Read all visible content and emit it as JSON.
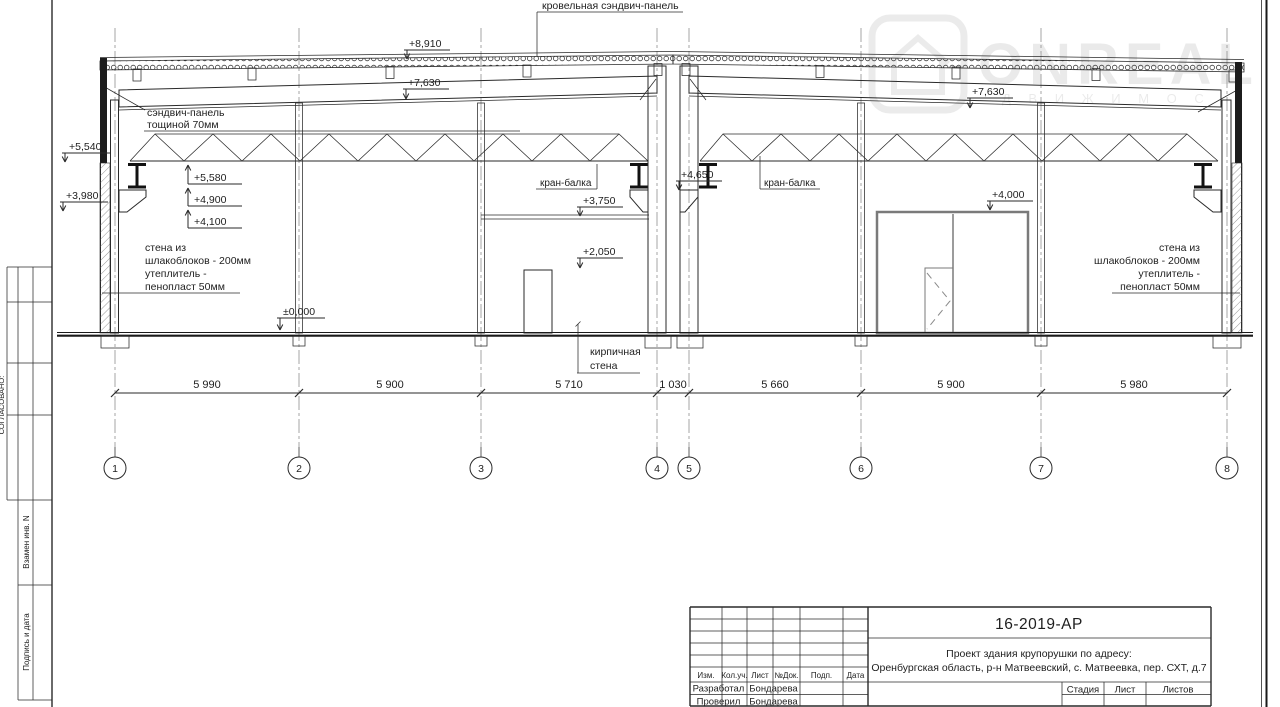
{
  "watermark": {
    "brand": "ONREAL",
    "subtitle": "Д В И Ж И М О С"
  },
  "drawing": {
    "annotations": {
      "roof_panel": "кровельная сэндвич-панель",
      "sandwich_line1": "сэндвич-панель",
      "sandwich_line2": "тощиной 70мм",
      "crane_beam_left": "кран-балка",
      "crane_beam_right": "кран-балка",
      "wall_left_line1": "стена из",
      "wall_left_line2": "шлакоблоков - 200мм",
      "wall_left_line3": "утеплитель -",
      "wall_left_line4": "пенопласт 50мм",
      "wall_right_line1": "стена из",
      "wall_right_line2": "шлакоблоков - 200мм",
      "wall_right_line3": "утеплитель -",
      "wall_right_line4": "пенопласт 50мм",
      "brick_wall_line1": "кирпичная",
      "brick_wall_line2": "стена"
    },
    "elevations": {
      "roof_top": "+8,910",
      "beam_left": "+7,630",
      "beam_right": "+7,630",
      "left_upper": "+5,540",
      "left_lower": "+3,980",
      "truss_bottom": "+5,580",
      "crane_rail": "+4,900",
      "corbel": "+4,100",
      "center": "+4,650",
      "brick_top": "+3,750",
      "door_top": "+2,050",
      "ground": "±0,000",
      "gate_top": "+4,000"
    },
    "dimensions": [
      "5 990",
      "5 900",
      "5 710",
      "1 030",
      "5 660",
      "5 900",
      "5 980"
    ],
    "axes": [
      "1",
      "2",
      "3",
      "4",
      "5",
      "6",
      "7",
      "8"
    ]
  },
  "sidebar": {
    "agreed": "СОГЛАСОВАНО:",
    "replace_inv": "Взамен инв. N",
    "sign_date": "Подпись и дата"
  },
  "titleblock": {
    "doc_number": "16-2019-АР",
    "project_line1": "Проект здания крупорушки по адресу:",
    "project_line2": "Оренбургская область, р-н Матвеевский, с. Матвеевка, пер. СХТ, д.7",
    "col_izm": "Изм.",
    "col_koluch": "Кол.уч.",
    "col_list": "Лист",
    "col_ndok": "№Док.",
    "col_podp": "Подп.",
    "col_data": "Дата",
    "row1_role": "Разработал",
    "row1_name": "Бондарева",
    "row2_role": "Проверил",
    "row2_name": "Бондарева",
    "stage": "Стадия",
    "sheet": "Лист",
    "sheets": "Листов"
  }
}
